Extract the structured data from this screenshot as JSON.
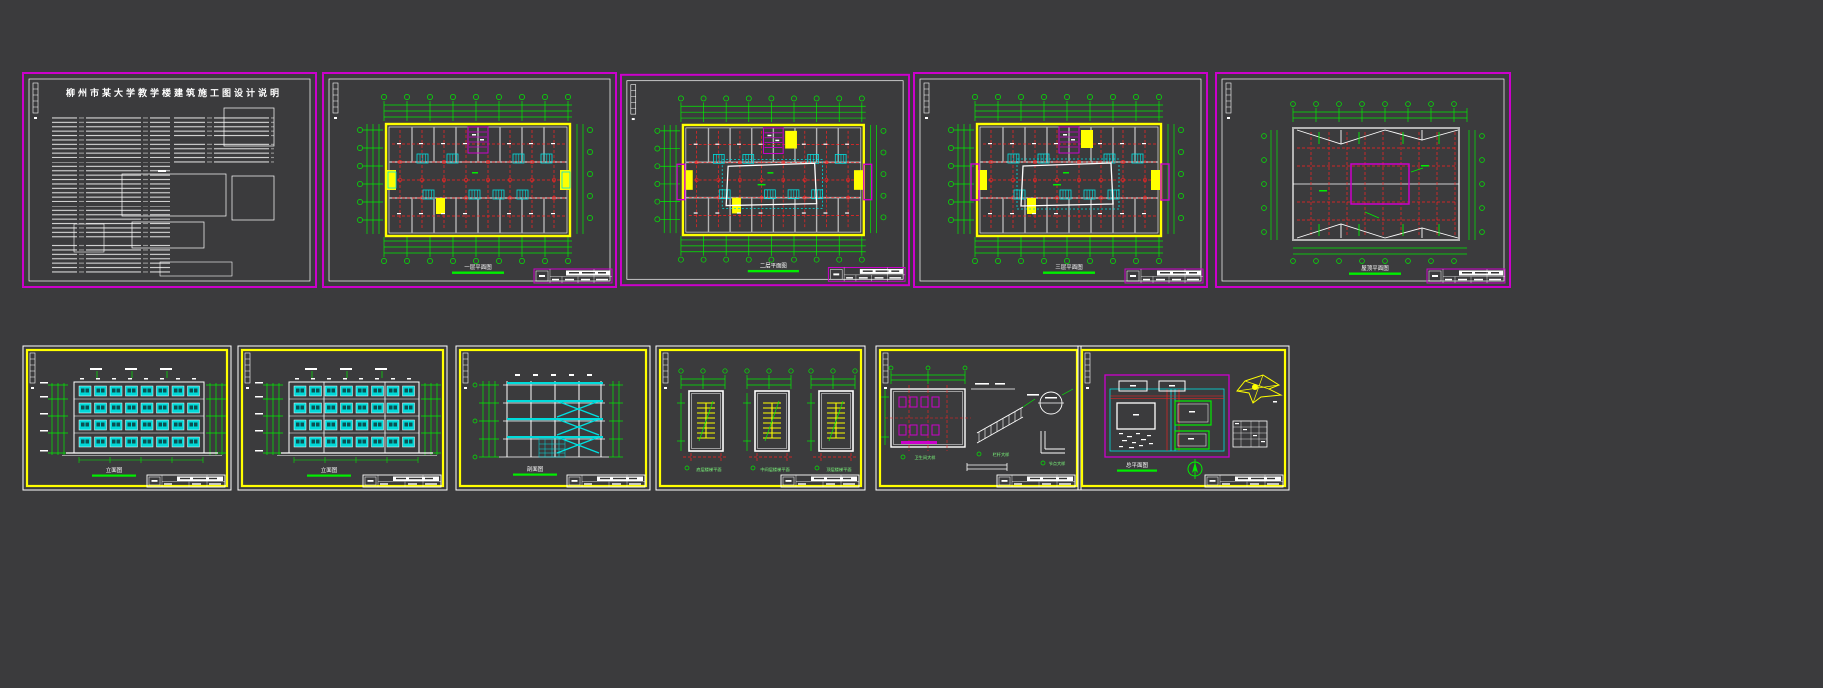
{
  "canvas": {
    "width": 1823,
    "height": 688,
    "background": "#3b3b3d"
  },
  "palette": {
    "sheet_border_top_row": "#cc00cc",
    "sheet_border_bottom_row": "#ffff00",
    "dimension_green": "#00ee00",
    "axis_red": "#ff2222",
    "wall_gray": "#b4b4b4",
    "glazing_cyan": "#00e0e0",
    "highlight_yellow": "#ffff00",
    "line_white": "#ffffff"
  },
  "sheets": {
    "top_row": [
      {
        "name": "建筑设计说明",
        "title": "柳州市某大学教学楼建筑施工图设计说明"
      },
      {
        "name": "一层平面图",
        "caption": "一层平面图"
      },
      {
        "name": "二层平面图",
        "caption": "二层平面图"
      },
      {
        "name": "三层平面图",
        "caption": "三层平面图"
      },
      {
        "name": "屋顶平面图",
        "caption": "屋顶平面图"
      }
    ],
    "bottom_row": [
      {
        "name": "立面图一",
        "caption": "立面图"
      },
      {
        "name": "立面图二",
        "caption": "立面图"
      },
      {
        "name": "剖面图",
        "caption": "剖面图"
      },
      {
        "name": "楼梯大样",
        "captions": [
          "底层楼梯平面",
          "中间层楼梯平面",
          "顶层楼梯平面"
        ]
      },
      {
        "name": "节点详图",
        "captions": [
          "卫生间大样",
          "栏杆大样",
          "节点大样"
        ]
      },
      {
        "name": "总平面图",
        "caption": "总平面图"
      }
    ]
  }
}
